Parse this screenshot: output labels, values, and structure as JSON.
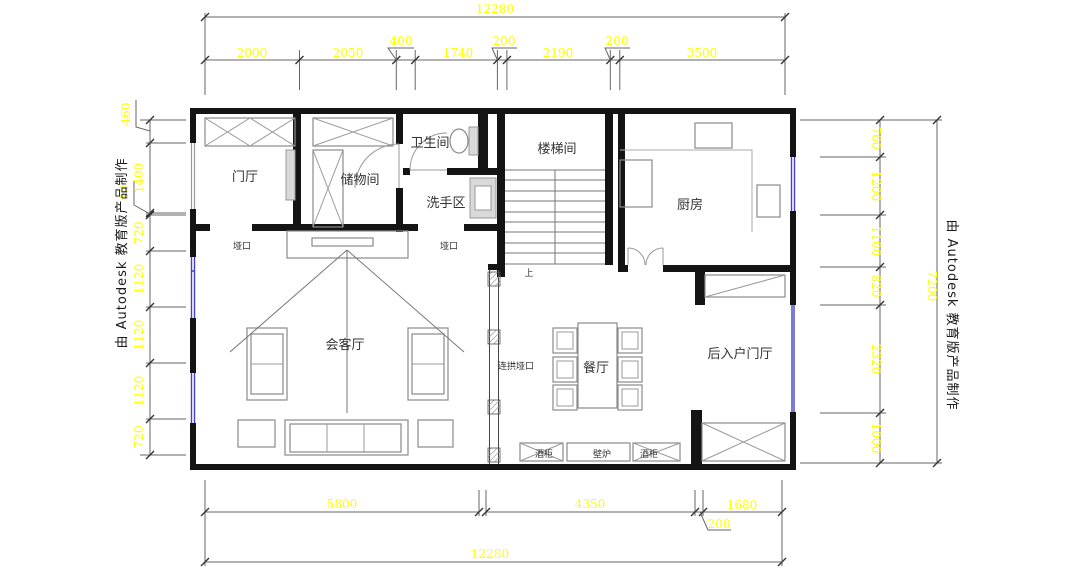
{
  "watermark": {
    "left": "由 Autodesk 教育版产品制作",
    "right": "由 Autodesk 教育版产品制作"
  },
  "rooms": {
    "entry_hall": "门厅",
    "storage": "储物间",
    "bathroom": "卫生间",
    "wash_area": "洗手区",
    "stairwell": "楼梯间",
    "kitchen": "厨房",
    "living_room": "会客厅",
    "dining_room": "餐厅",
    "rear_entry_hall": "后入户门厅"
  },
  "annotations": {
    "opening_left": "垭口",
    "opening_right": "垭口",
    "arch_opening": "连拱垭口",
    "stairs_up": "上",
    "wine_cabinet_left": "酒柜",
    "fireplace": "壁炉",
    "wine_cabinet_right": "酒柜"
  },
  "dimensions": {
    "top_total": "12280",
    "top_chain": [
      "2000",
      "2050",
      "400",
      "1740",
      "200",
      "2190",
      "200",
      "3500"
    ],
    "bottom_chain": [
      "5800",
      "4350",
      "200",
      "1680"
    ],
    "bottom_total": "12280",
    "left_chain": [
      "460",
      "1400",
      "40",
      "720",
      "1120",
      "1120",
      "1120",
      "720"
    ],
    "right_chain": [
      "760",
      "1200",
      "1100",
      "820",
      "2320",
      "1000"
    ],
    "right_total": "7200"
  },
  "colors": {
    "dimension_text": "#ffff00",
    "wall": "#141414",
    "window": "#4040cc",
    "furniture": "#8a8a8a"
  }
}
